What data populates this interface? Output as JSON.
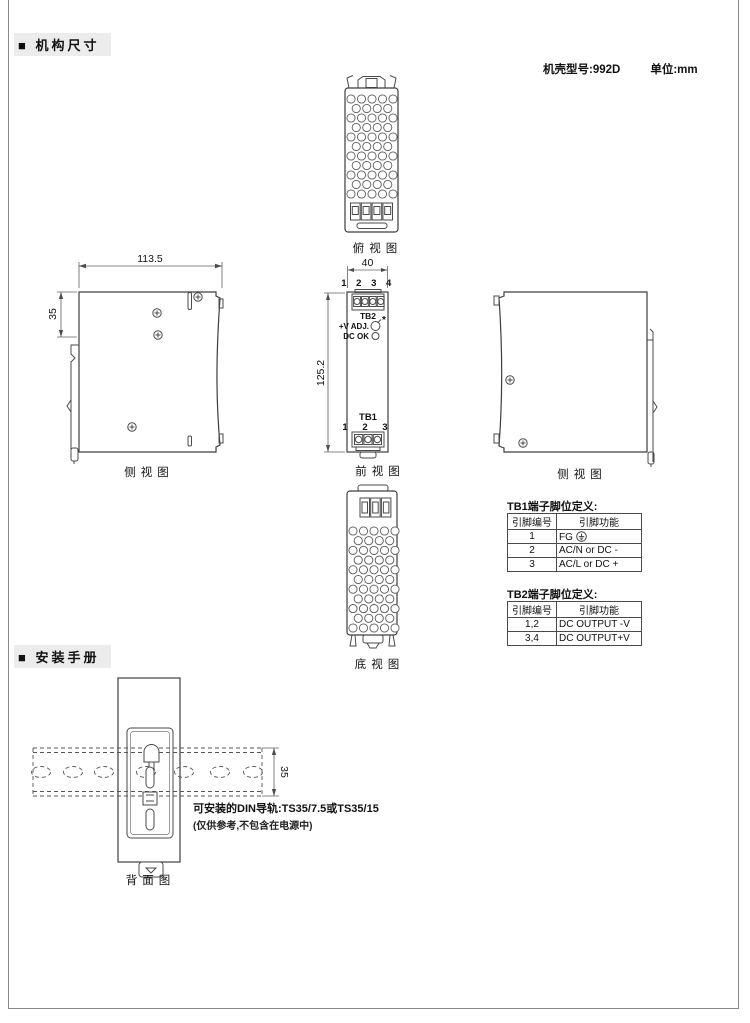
{
  "header": {
    "section_mechanical": "■ 机构尺寸",
    "case_model": "机壳型号:992D",
    "unit": "单位:mm",
    "section_install": "■ 安装手册"
  },
  "labels": {
    "top_view": "俯视图",
    "side_view_left": "侧视图",
    "front_view": "前视图",
    "side_view_right": "侧视图",
    "bottom_view": "底视图",
    "back_view": "背面图"
  },
  "dims": {
    "depth": "113.5",
    "clip_offset": "35",
    "width": "40",
    "height": "125.2",
    "rail_width": "35"
  },
  "front": {
    "tb2_pins": "1 2 3 4",
    "tb2": "TB2",
    "vadj": "+V ADJ.",
    "star": "*",
    "dcok": "DC OK",
    "tb1": "TB1",
    "tb1_pins": "1 2 3"
  },
  "tb1": {
    "title": "TB1端子脚位定义:",
    "col_pin": "引脚编号",
    "col_func": "引脚功能",
    "rows": [
      {
        "pin": "1",
        "func": "FG"
      },
      {
        "pin": "2",
        "func": "AC/N or DC -"
      },
      {
        "pin": "3",
        "func": "AC/L  or DC +"
      }
    ]
  },
  "tb2": {
    "title": "TB2端子脚位定义:",
    "col_pin": "引脚编号",
    "col_func": "引脚功能",
    "rows": [
      {
        "pin": "1,2",
        "func": "DC OUTPUT -V"
      },
      {
        "pin": "3,4",
        "func": "DC OUTPUT+V"
      }
    ]
  },
  "install": {
    "rail_note": "可安装的DIN导轨:TS35/7.5或TS35/15",
    "ref_note": "(仅供参考,不包含在电源中)"
  }
}
